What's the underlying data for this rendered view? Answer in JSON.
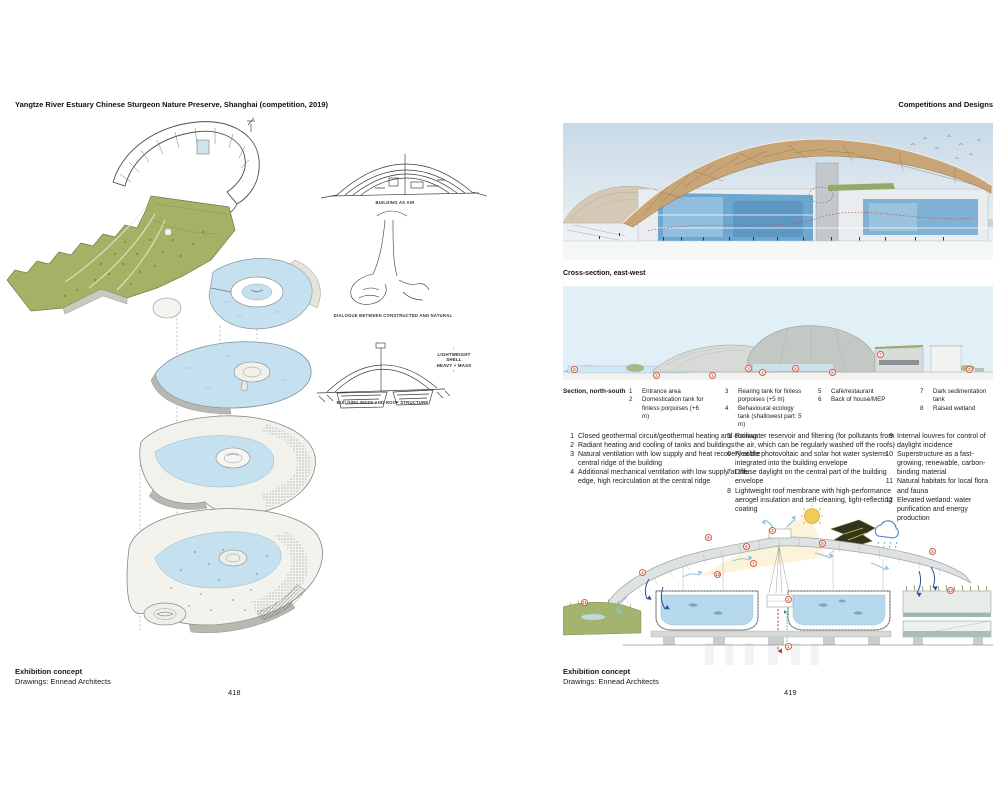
{
  "colors": {
    "accent_red": "#cf5b44",
    "water_blue": "#c5e1f0",
    "landscape_green": "#a7b166",
    "timber_tan": "#c8a271",
    "sky_blue": "#e1eff7"
  },
  "icons": {
    "up_arrow": "↑",
    "down_arrow": "↓"
  },
  "page_left": {
    "header": "Yangtze River Estuary Chinese Sturgeon Nature Preserve, Shanghai (competition, 2019)",
    "sketch_captions": [
      "BUILDING AS AIR",
      "DIALOGUE BETWEEN CONSTRUCTED AND NATURAL",
      "BUILDING MASS AND ROOF STRUCTURE"
    ],
    "annotation_top": "LIGHTWEIGHT SHELL",
    "annotation_bottom": "HEAVY + MASS",
    "caption_title": "Exhibition concept",
    "caption_credit": "Drawings: Ennead Architects",
    "page_number": "418"
  },
  "page_right": {
    "header": "Competitions and Designs",
    "cross_section_label": "Cross-section, east-west",
    "section_label": "Section, north-south",
    "section_legend": [
      {
        "num": "1",
        "text": "Entrance area"
      },
      {
        "num": "2",
        "text": "Domestication tank for finless porpoises (+6 m)"
      },
      {
        "num": "3",
        "text": "Rearing tank for finless porpoises (+5 m)"
      },
      {
        "num": "4",
        "text": "Behavioural ecology tank (shallowest part: 5 m)"
      },
      {
        "num": "5",
        "text": "Café/restaurant"
      },
      {
        "num": "6",
        "text": "Back of house/MEP"
      },
      {
        "num": "7",
        "text": "Dark sedimentation tank"
      },
      {
        "num": "8",
        "text": "Raised wetland"
      }
    ],
    "systems_list": [
      {
        "num": "1",
        "text": "Closed geothermal circuit/geothermal heating and cooling"
      },
      {
        "num": "2",
        "text": "Radiant heating and cooling of tanks and buildings"
      },
      {
        "num": "3",
        "text": "Natural ventilation with low supply and heat recovery at the central ridge of the building"
      },
      {
        "num": "4",
        "text": "Additional mechanical ventilation with low supply at the edge, high recirculation at the central ridge"
      },
      {
        "num": "5",
        "text": "Rainwater reservoir and filtering (for pollutants from the air, which can be regularly washed off the roofs)"
      },
      {
        "num": "6",
        "text": "Flexible photovoltaic and solar hot water systems integrated into the building envelope"
      },
      {
        "num": "7",
        "text": "Diffuse daylight on the central part of the building envelope"
      },
      {
        "num": "8",
        "text": "Lightweight roof membrane with high-performance aerogel insulation and self-cleaning, light-reflecting coating"
      },
      {
        "num": "9",
        "text": "Internal louvres for control of daylight incidence"
      },
      {
        "num": "10",
        "text": "Superstructure as a fast-growing, renewable, carbon-binding material"
      },
      {
        "num": "11",
        "text": "Natural habitats for local flora and fauna"
      },
      {
        "num": "12",
        "text": "Elevated wetland: water purification and energy production"
      }
    ],
    "section_markers": [
      "8",
      "2",
      "1",
      "3",
      "4",
      "5",
      "6",
      "7",
      "8"
    ],
    "diagram_markers": [
      "9",
      "3",
      "6",
      "8",
      "7",
      "4",
      "10",
      "5",
      "12",
      "11",
      "2",
      "1"
    ],
    "caption_title": "Exhibition concept",
    "caption_credit": "Drawings: Ennead Architects",
    "page_number": "419"
  }
}
